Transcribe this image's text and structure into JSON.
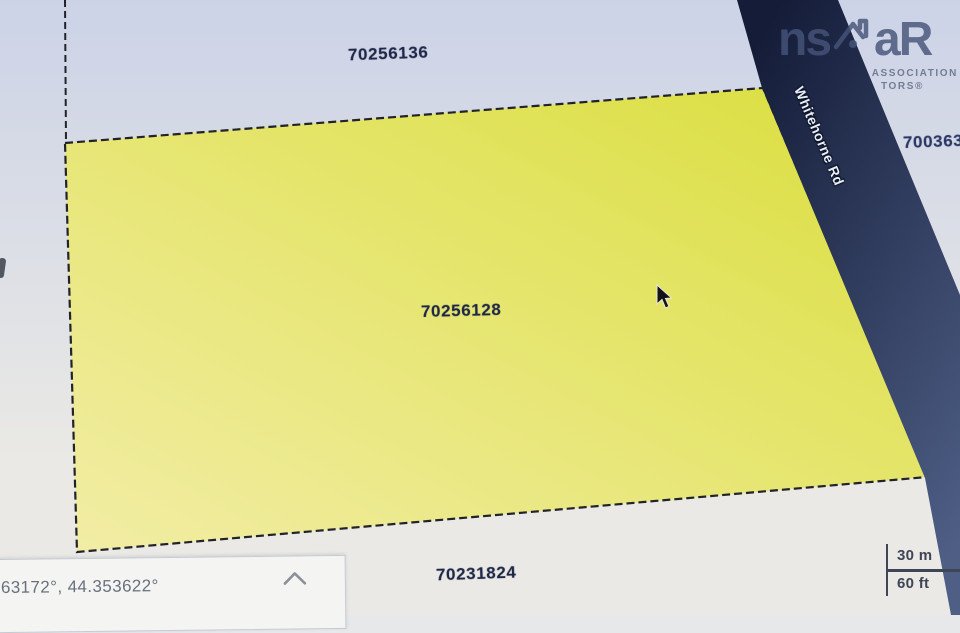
{
  "parcels": {
    "north": {
      "id": "70256136"
    },
    "selected": {
      "id": "70256128"
    },
    "south": {
      "id": "70231824"
    },
    "east_clipped": {
      "id": "700363"
    }
  },
  "road": {
    "name": "Whitehorne Rd"
  },
  "logo": {
    "text_left": "ns",
    "text_right": "aR",
    "tagline_line1": "ASSOCIATION",
    "tagline_line2": "TORS®"
  },
  "statusbar": {
    "coordinates": "63172°, 44.353622°"
  },
  "scalebar": {
    "metric_label": "30 m",
    "imperial_label": "60 ft"
  },
  "colors": {
    "bg_top": "#ccd3e7",
    "bg_bottom": "#eae9e5",
    "parcel_top_right": "#dade3c",
    "parcel_bottom_left": "#f2eda6",
    "road_top": "#141c38",
    "road_bottom": "#4e5e85",
    "boundary": "#22232a"
  }
}
